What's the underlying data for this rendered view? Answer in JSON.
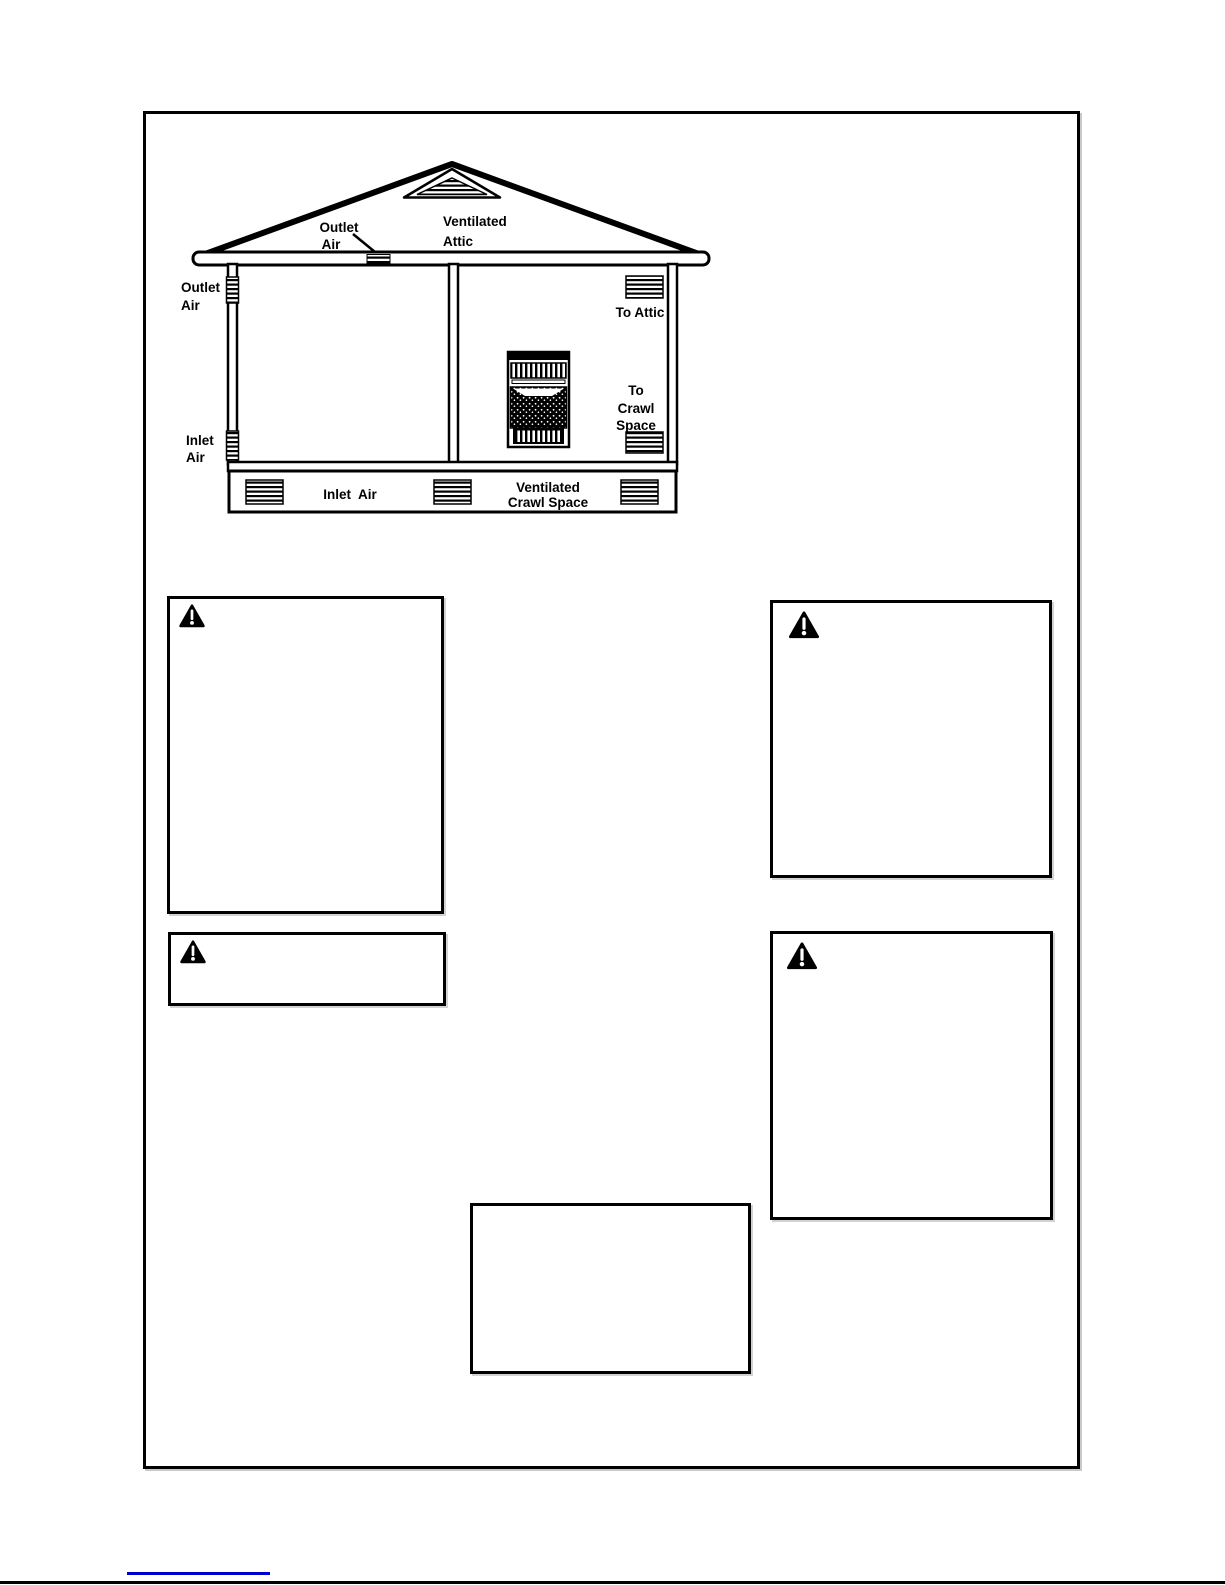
{
  "diagram": {
    "labels": {
      "roof_outlet_1": "Outlet",
      "roof_outlet_2": "Air",
      "ventilated_attic_1": "Ventilated",
      "ventilated_attic_2": "Attic",
      "wall_outlet_1": "Outlet",
      "wall_outlet_2": "Air",
      "to_attic": "To Attic",
      "to_crawl_1": "To",
      "to_crawl_2": "Crawl",
      "to_crawl_3": "Space",
      "wall_inlet_1": "Inlet",
      "wall_inlet_2": "Air",
      "crawl_inlet": "Inlet  Air",
      "ventilated_crawl_1": "Ventilated",
      "ventilated_crawl_2": "Crawl Space"
    }
  },
  "warning_boxes": [
    {
      "position": "top-left",
      "icon": "warning-triangle-icon",
      "text": ""
    },
    {
      "position": "top-right",
      "icon": "warning-triangle-icon",
      "text": ""
    },
    {
      "position": "mid-left-small",
      "icon": "warning-triangle-icon",
      "text": ""
    },
    {
      "position": "mid-right-tall",
      "icon": "warning-triangle-icon",
      "text": ""
    },
    {
      "position": "bottom-center",
      "icon": "none",
      "text": ""
    }
  ],
  "icons": {
    "warning": "warning-triangle-icon",
    "gable_vent": "gable-vent-icon",
    "louver_vent": "louver-vent-icon",
    "heater": "gas-heater-icon"
  },
  "colors": {
    "ink": "#000000",
    "link_underline": "#0000cc",
    "page_background": "#ffffff"
  }
}
